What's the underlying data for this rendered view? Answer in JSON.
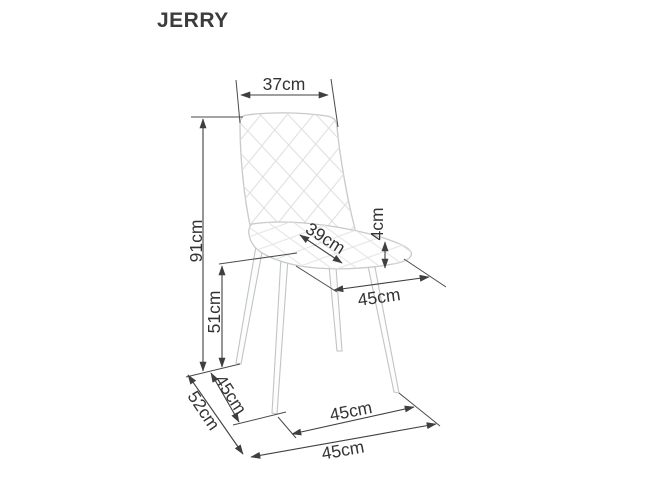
{
  "title": "JERRY",
  "diagram": {
    "type": "product-dimension-drawing",
    "subject": "quilted-upholstered-chair-three-quarter-view",
    "unit": "cm",
    "colors": {
      "background": "#ffffff",
      "line_art": "#c6cac9",
      "dimension_lines": "#3f3f3f",
      "label_text": "#333333"
    },
    "dimensions": {
      "backrest_width": "37cm",
      "total_height": "91cm",
      "floor_to_seat_height": "51cm",
      "seat_depth": "39cm",
      "seat_thickness": "4cm",
      "seat_width": "45cm",
      "leg_span_depth": "45cm",
      "total_depth": "52cm",
      "front_leg_span": "45cm",
      "total_width": "45cm"
    }
  }
}
